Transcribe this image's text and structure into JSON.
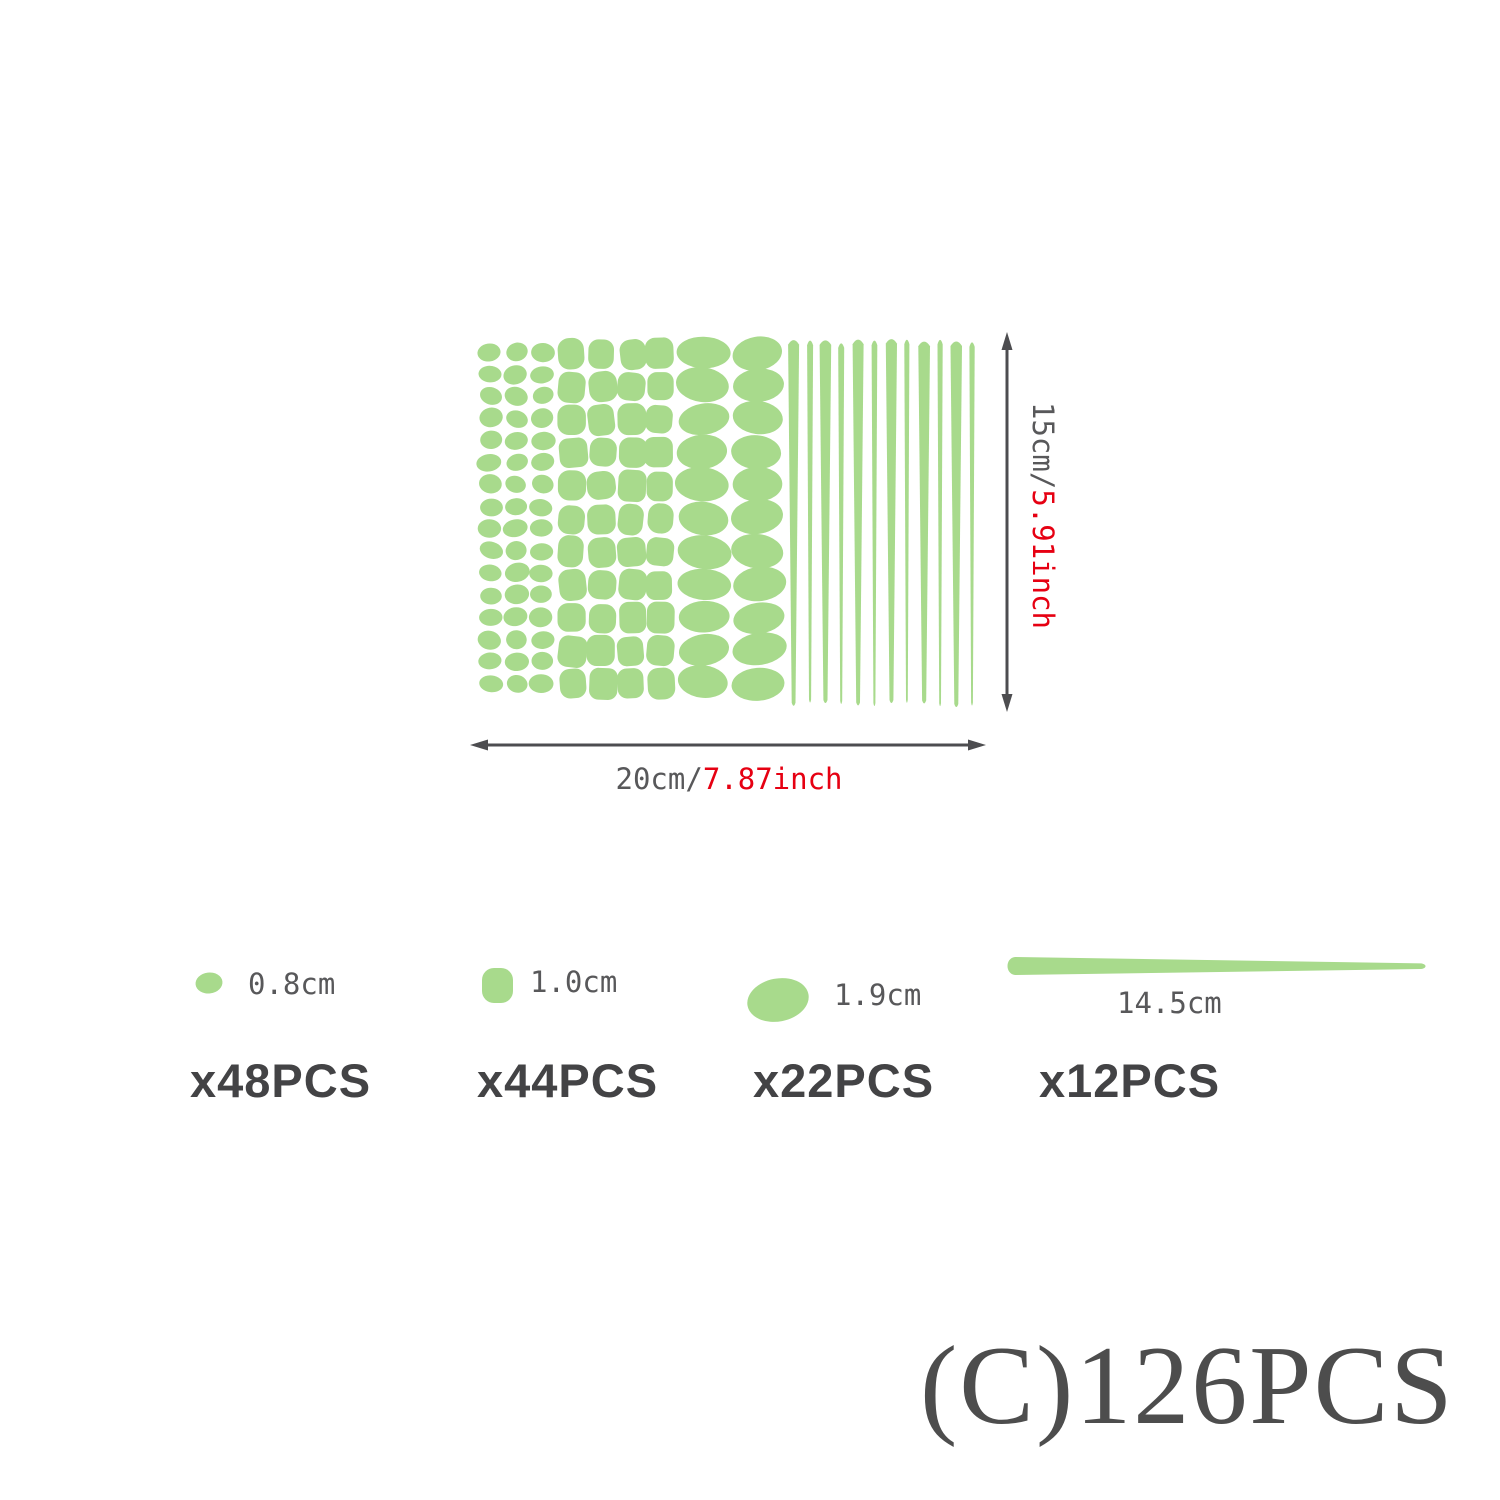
{
  "colors": {
    "green": "#a8da8c",
    "arrow_gray": "#4d4d50",
    "label_gray": "#58585a",
    "accent_red": "#e60012",
    "count_dark": "#434345",
    "footer_gray": "#4d4d4d"
  },
  "sheet": {
    "small_dots": {
      "cols": 3,
      "rows": 16
    },
    "medium_dots": {
      "cols": 4,
      "rows": 11
    },
    "large_dots": {
      "cols": 2,
      "rows": 11
    },
    "stripes": {
      "count": 12
    }
  },
  "dimensions": {
    "height_cm": "15cm/",
    "height_inch": "5.91inch",
    "width_cm": "20cm/",
    "width_inch": "7.87inch"
  },
  "legend": [
    {
      "shape": "small-dot",
      "size": "0.8cm",
      "count": "x48PCS"
    },
    {
      "shape": "medium-dot",
      "size": "1.0cm",
      "count": "x44PCS"
    },
    {
      "shape": "large-dot",
      "size": "1.9cm",
      "count": "x22PCS"
    },
    {
      "shape": "stripe",
      "size": "14.5cm",
      "count": "x12PCS"
    }
  ],
  "footer": {
    "label": "(C)126PCS"
  }
}
